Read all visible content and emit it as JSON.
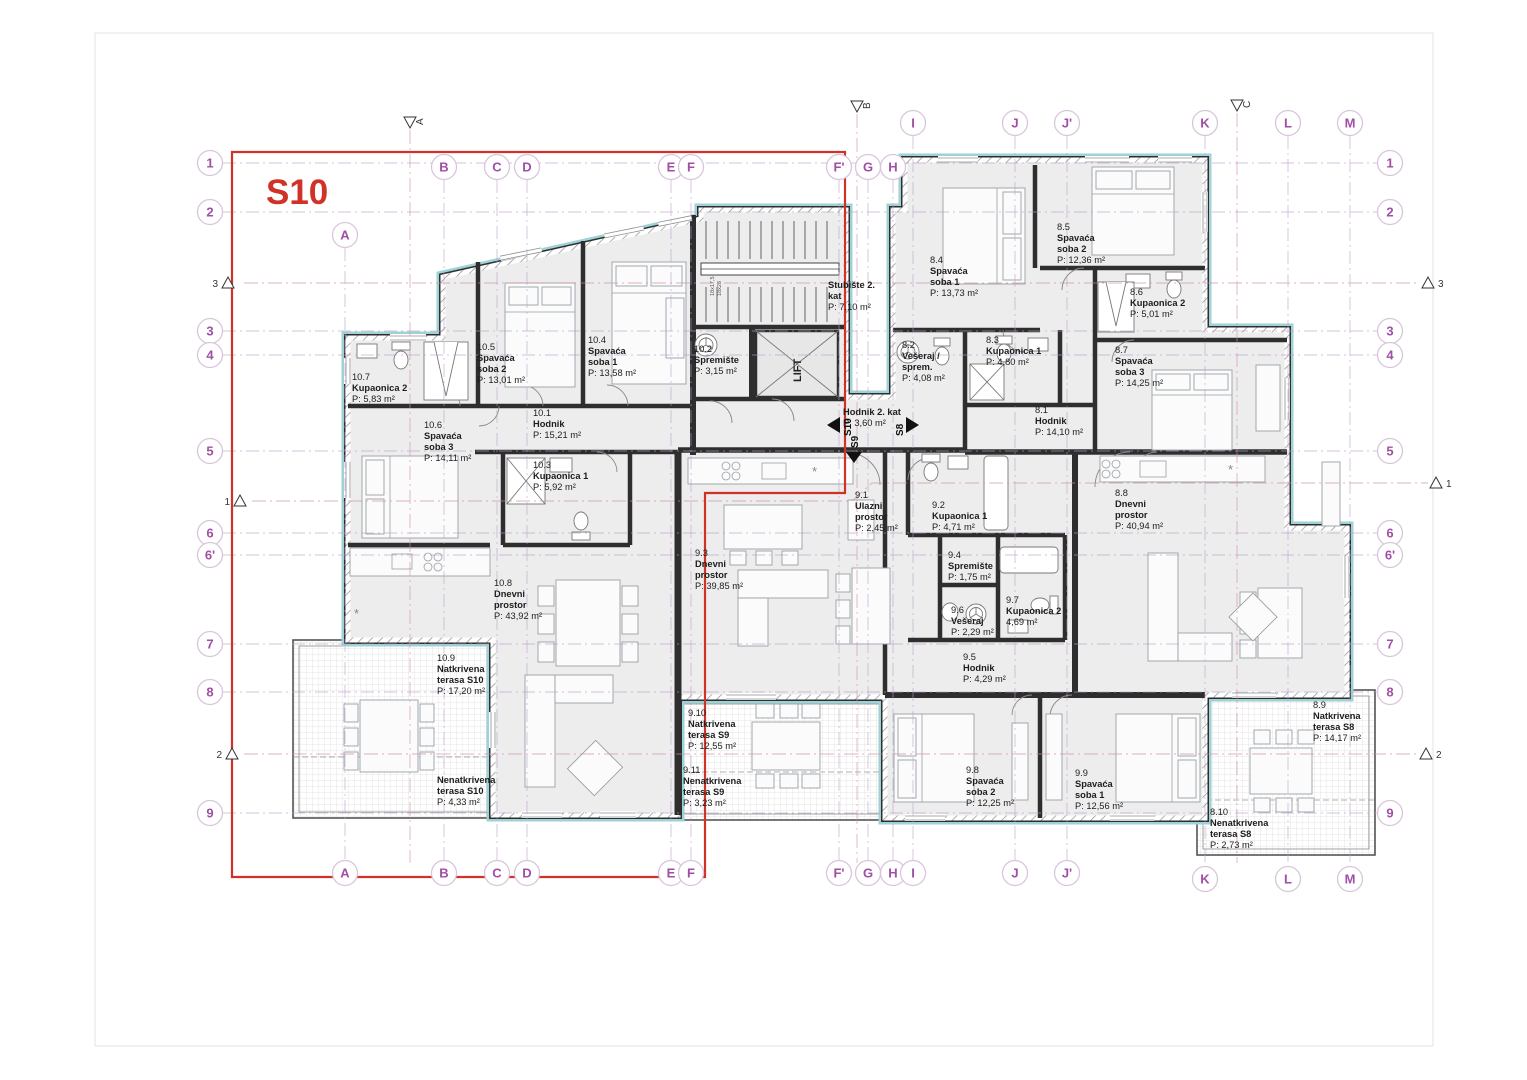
{
  "title_block": {
    "unit_label": "S10"
  },
  "lift": {
    "label": "LIFT"
  },
  "stairs": {
    "dims": [
      "18x17,5",
      "18x28"
    ]
  },
  "colors": {
    "accent_red": "#d03227",
    "wall": "#2e2e2e",
    "insulation_cyan": "#9ed2d6",
    "room_fill": "#ededed",
    "grid_purple": "#a14fa6",
    "grid_line": "#bb9cc8",
    "section_line": "#cf8fa6"
  },
  "grid": {
    "cols": [
      {
        "label": "A",
        "x": 345,
        "cy_top": 235,
        "cy_bot": 873
      },
      {
        "label": "B",
        "x": 444,
        "cy_top": 167,
        "cy_bot": 873
      },
      {
        "label": "C",
        "x": 497,
        "cy_top": 167,
        "cy_bot": 873
      },
      {
        "label": "D",
        "x": 527,
        "cy_top": 167,
        "cy_bot": 873
      },
      {
        "label": "E",
        "x": 671,
        "cy_top": 167,
        "cy_bot": 873
      },
      {
        "label": "F",
        "x": 691,
        "cy_top": 167,
        "cy_bot": 873
      },
      {
        "label": "F'",
        "x": 839,
        "cy_top": 167,
        "cy_bot": 873
      },
      {
        "label": "G",
        "x": 868,
        "cy_top": 167,
        "cy_bot": 873
      },
      {
        "label": "H",
        "x": 893,
        "cy_top": 167,
        "cy_bot": 873
      },
      {
        "label": "I",
        "x": 913,
        "cy_top": 123,
        "cy_bot": 873
      },
      {
        "label": "J",
        "x": 1015,
        "cy_top": 123,
        "cy_bot": 873
      },
      {
        "label": "J'",
        "x": 1067,
        "cy_top": 123,
        "cy_bot": 873
      },
      {
        "label": "K",
        "x": 1205,
        "cy_top": 123,
        "cy_bot": 879
      },
      {
        "label": "L",
        "x": 1288,
        "cy_top": 123,
        "cy_bot": 879
      },
      {
        "label": "M",
        "x": 1350,
        "cy_top": 123,
        "cy_bot": 879
      }
    ],
    "rows": [
      {
        "label": "1",
        "y": 163
      },
      {
        "label": "2",
        "y": 212
      },
      {
        "label": "3",
        "y": 331
      },
      {
        "label": "4",
        "y": 355
      },
      {
        "label": "5",
        "y": 451
      },
      {
        "label": "6",
        "y": 533
      },
      {
        "label": "6'",
        "y": 555
      },
      {
        "label": "7",
        "y": 644
      },
      {
        "label": "8",
        "y": 692
      },
      {
        "label": "9",
        "y": 813
      }
    ],
    "row_cx_left": 210,
    "row_cx_right": 1390
  },
  "sections": [
    {
      "label": "A",
      "side": "top",
      "x": 410,
      "y": 122
    },
    {
      "label": "B",
      "side": "top",
      "x": 857,
      "y": 106
    },
    {
      "label": "C",
      "side": "top",
      "x": 1237,
      "y": 105
    },
    {
      "label": "3",
      "side": "left",
      "x": 228,
      "y": 283
    },
    {
      "label": "3",
      "side": "right",
      "x": 1428,
      "y": 283
    },
    {
      "label": "1",
      "side": "left",
      "x": 240,
      "y": 501
    },
    {
      "label": "1",
      "side": "right",
      "x": 1436,
      "y": 483
    },
    {
      "label": "2",
      "side": "left",
      "x": 232,
      "y": 754
    },
    {
      "label": "2",
      "side": "right",
      "x": 1426,
      "y": 754
    }
  ],
  "section_lines": {
    "v": [
      {
        "x": 410,
        "y1": 130,
        "y2": 863
      },
      {
        "x": 857,
        "y1": 114,
        "y2": 863
      },
      {
        "x": 1237,
        "y1": 113,
        "y2": 863
      }
    ],
    "h": [
      "244,283 1420,283",
      "252,501 852,501 872,483 1428,483",
      "244,754 1418,754"
    ]
  },
  "rooms": [
    {
      "id": "10.7",
      "name": [
        "Kupaonica 2"
      ],
      "area": "P: 5,83 m²",
      "x": 352,
      "y": 380
    },
    {
      "id": "10.5",
      "name": [
        "Spavaća",
        "soba 2"
      ],
      "area": "P: 13,01 m²",
      "x": 477,
      "y": 350
    },
    {
      "id": "10.4",
      "name": [
        "Spavaća",
        "soba 1"
      ],
      "area": "P: 13,58 m²",
      "x": 588,
      "y": 343
    },
    {
      "id": "10.2",
      "name": [
        "Spremište"
      ],
      "area": "P: 3,15 m²",
      "x": 694,
      "y": 352
    },
    {
      "id": "10.6",
      "name": [
        "Spavaća",
        "soba 3"
      ],
      "area": "P: 14,11 m²",
      "x": 424,
      "y": 428
    },
    {
      "id": "10.1",
      "name": [
        "Hodnik"
      ],
      "area": "P: 15,21 m²",
      "x": 533,
      "y": 416
    },
    {
      "id": "10.3",
      "name": [
        "Kupaonica 1"
      ],
      "area": "P: 5,92 m²",
      "x": 533,
      "y": 468
    },
    {
      "id": "10.8",
      "name": [
        "Dnevni",
        "prostor"
      ],
      "area": "P: 43,92 m²",
      "x": 494,
      "y": 586
    },
    {
      "id": "10.9",
      "name": [
        "Natkrivena",
        "terasa S10"
      ],
      "area": "P: 17,20 m²",
      "x": 437,
      "y": 661
    },
    {
      "id": "",
      "name": [
        "Nenatkrivena",
        "terasa S10"
      ],
      "area": "P: 4,33 m²",
      "x": 437,
      "y": 783
    },
    {
      "id": "",
      "name": [
        "Stubište 2.",
        "kat"
      ],
      "area": "P: 7,10 m²",
      "x": 828,
      "y": 288
    },
    {
      "id": "",
      "name": [
        "Hodnik 2. kat"
      ],
      "area": "P: 3,60 m²",
      "x": 843,
      "y": 415
    },
    {
      "id": "9.1",
      "name": [
        "Ulazni",
        "prostor"
      ],
      "area": "P: 2,45 m²",
      "x": 855,
      "y": 498
    },
    {
      "id": "9.2",
      "name": [
        "Kupaonica 1"
      ],
      "area": "P: 4,71 m²",
      "x": 932,
      "y": 508
    },
    {
      "id": "9.3",
      "name": [
        "Dnevni",
        "prostor"
      ],
      "area": "P: 39,85 m²",
      "x": 695,
      "y": 556
    },
    {
      "id": "9.4",
      "name": [
        "Spremište"
      ],
      "area": "P: 1,75 m²",
      "x": 948,
      "y": 558
    },
    {
      "id": "9.6",
      "name": [
        "Vešeraj"
      ],
      "area": "P: 2,29 m²",
      "x": 951,
      "y": 613
    },
    {
      "id": "9.7",
      "name": [
        "Kupaonica 2"
      ],
      "area": "4,69 m²",
      "x": 1006,
      "y": 603
    },
    {
      "id": "9.5",
      "name": [
        "Hodnik"
      ],
      "area": "P: 4,29 m²",
      "x": 963,
      "y": 660
    },
    {
      "id": "9.10",
      "name": [
        "Natkrivena",
        "terasa S9"
      ],
      "area": "P: 12,55 m²",
      "x": 688,
      "y": 716
    },
    {
      "id": "9.11",
      "name": [
        "Nenatkrivena",
        "terasa S9"
      ],
      "area": "P: 3,23 m²",
      "x": 683,
      "y": 773
    },
    {
      "id": "9.8",
      "name": [
        "Spavaća",
        "soba 2"
      ],
      "area": "P: 12,25 m²",
      "x": 966,
      "y": 773
    },
    {
      "id": "9.9",
      "name": [
        "Spavaća",
        "soba 1"
      ],
      "area": "P: 12,56 m²",
      "x": 1075,
      "y": 776
    },
    {
      "id": "8.4",
      "name": [
        "Spavaća",
        "soba 1"
      ],
      "area": "P: 13,73 m²",
      "x": 930,
      "y": 263
    },
    {
      "id": "8.5",
      "name": [
        "Spavaća",
        "soba 2"
      ],
      "area": "P: 12,36 m²",
      "x": 1057,
      "y": 230
    },
    {
      "id": "8.6",
      "name": [
        "Kupaonica 2"
      ],
      "area": "P: 5,01 m²",
      "x": 1130,
      "y": 295
    },
    {
      "id": "8.2",
      "name": [
        "Vešeraj /",
        "sprem."
      ],
      "area": "P: 4,08 m²",
      "x": 902,
      "y": 348
    },
    {
      "id": "8.3",
      "name": [
        "Kupaonica 1"
      ],
      "area": "P: 4,80 m²",
      "x": 986,
      "y": 343
    },
    {
      "id": "8.7",
      "name": [
        "Spavaća",
        "soba 3"
      ],
      "area": "P: 14,25 m²",
      "x": 1115,
      "y": 353
    },
    {
      "id": "8.1",
      "name": [
        "Hodnik"
      ],
      "area": "P: 14,10 m²",
      "x": 1035,
      "y": 413
    },
    {
      "id": "8.8",
      "name": [
        "Dnevni",
        "prostor"
      ],
      "area": "P: 40,94 m²",
      "x": 1115,
      "y": 496
    },
    {
      "id": "8.9",
      "name": [
        "Natkrivena",
        "terasa S8"
      ],
      "area": "P: 14,17 m²",
      "x": 1313,
      "y": 708
    },
    {
      "id": "8.10",
      "name": [
        "Nenatkrivena",
        "terasa S8"
      ],
      "area": "P: 2,73 m²",
      "x": 1210,
      "y": 815
    }
  ],
  "entry_arrows": [
    {
      "label": "S10",
      "dir": "left",
      "x": 827,
      "y": 425
    },
    {
      "label": "S9",
      "dir": "down",
      "x": 854,
      "y": 452
    },
    {
      "label": "S8",
      "dir": "right",
      "x": 919,
      "y": 425
    }
  ]
}
